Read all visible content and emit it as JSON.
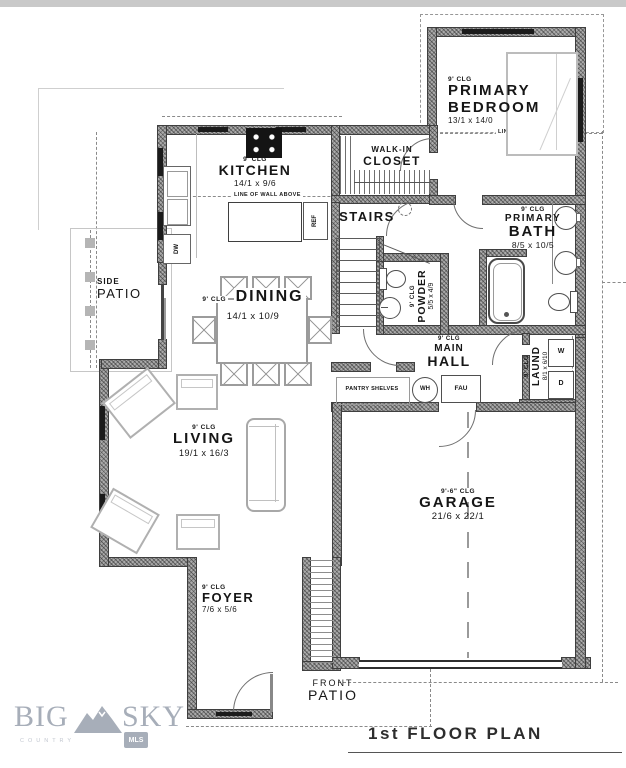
{
  "plan": {
    "title": "1st FLOOR PLAN",
    "rooms": {
      "primary_bedroom": {
        "ceiling": "9' CLG",
        "line1": "PRIMARY",
        "line2": "BEDROOM",
        "dims": "13/1 x 14/0"
      },
      "walkin_closet": {
        "line1": "WALK-IN",
        "line2": "CLOSET"
      },
      "kitchen": {
        "ceiling": "9' CLG",
        "line1": "KITCHEN",
        "dims": "14/1 x 9/6"
      },
      "stairs": {
        "line1": "STAIRS"
      },
      "primary_bath": {
        "ceiling": "9' CLG",
        "line1": "PRIMARY",
        "line2": "BATH",
        "dims": "8/5 x 10/5"
      },
      "powder": {
        "ceiling": "9' CLG",
        "line1": "POWDER",
        "dims": "5/5 x 4/9"
      },
      "main_hall": {
        "ceiling": "9' CLG",
        "line1": "MAIN",
        "line2": "HALL"
      },
      "laundry": {
        "ceiling": "9' CLG",
        "line1": "LAUND",
        "dims": "8/1 x 6/10"
      },
      "dining": {
        "ceiling": "9' CLG",
        "line1": "DINING",
        "dims": "14/1 x 10/9"
      },
      "living": {
        "ceiling": "9' CLG",
        "line1": "LIVING",
        "dims": "19/1 x 16/3"
      },
      "garage": {
        "ceiling": "9'-6\" CLG",
        "line1": "GARAGE",
        "dims": "21/6 x 22/1"
      },
      "foyer": {
        "ceiling": "9' CLG",
        "line1": "FOYER",
        "dims": "7/6 x 5/6"
      },
      "side_patio": {
        "line1": "SIDE",
        "line2": "PATIO"
      },
      "front_patio": {
        "line1": "FRONT",
        "line2": "PATIO"
      }
    },
    "annotations": {
      "line_of_wall_above": "LINE OF WALL ABOVE",
      "pantry_shelves": "PANTRY SHELVES"
    },
    "appliances": {
      "ref": "REF",
      "dw": "DW",
      "wh": "WH",
      "fau": "FAU",
      "washer": "W",
      "dryer": "D"
    }
  },
  "logo": {
    "big": "BIG",
    "sky": "SKY",
    "country": "COUNTRY",
    "mls": "MLS"
  },
  "colors": {
    "wall_fill": "#ababab",
    "line": "#3f3f3f",
    "furniture": "#aeaeae",
    "logo": "#a7aeb9"
  }
}
